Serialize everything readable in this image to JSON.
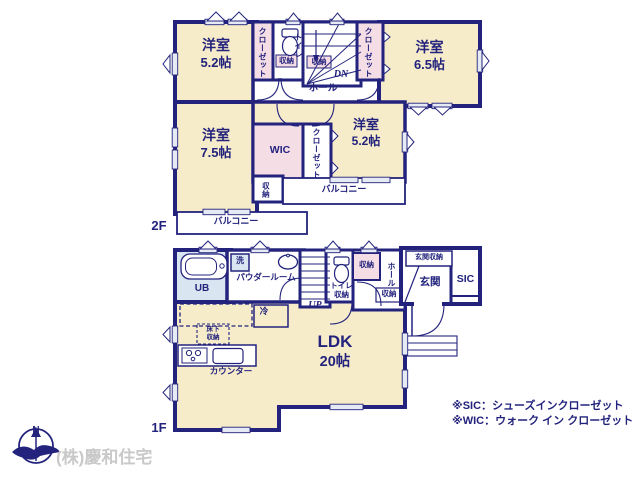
{
  "company": "(株)慶和住宅",
  "compass": {
    "north": "N"
  },
  "floor2": {
    "label": "2F",
    "bedroom_nw": {
      "name": "洋室",
      "size": "5.2帖"
    },
    "bedroom_ne": {
      "name": "洋室",
      "size": "6.5帖"
    },
    "bedroom_w": {
      "name": "洋室",
      "size": "7.5帖"
    },
    "bedroom_e": {
      "name": "洋室",
      "size": "5.2帖"
    },
    "wic": "WIC",
    "closet_nw": "クローゼット",
    "closet_ne": "クローゼット",
    "closet_e": "クローゼット",
    "toilet": "トイレ",
    "toilet_storage": "収納",
    "stairs_storage": "収納",
    "storage_south": "収納",
    "hall": "ホール",
    "down": "DN",
    "balcony_east": "バルコニー",
    "balcony_south": "バルコニー"
  },
  "floor1": {
    "label": "1F",
    "ldk": {
      "name": "LDK",
      "size": "20帖"
    },
    "ub": "UB",
    "washer": "洗",
    "powder_room": "パウダールーム",
    "up": "UP",
    "toilet": "トイレ",
    "toilet_storage": "収納",
    "hall_storage_north": "収納",
    "hall_storage_south": "収納",
    "hall": "ホール",
    "entrance_storage": "玄関収納",
    "entrance": "玄関",
    "sic": "SIC",
    "fridge": "冷",
    "underfloor_1": "床下",
    "underfloor_2": "収納",
    "counter": "カウンター"
  },
  "notes": {
    "sic": "※SIC：シューズインクローゼット",
    "wic": "※WIC：ウォーク イン クローゼット"
  },
  "colors": {
    "wall": "#23237d",
    "room": "#f6ecca",
    "closet": "#f5dde6",
    "bath": "#d9e6f2",
    "window": "#e6eaf4",
    "company_text": "#c9c9c9"
  }
}
